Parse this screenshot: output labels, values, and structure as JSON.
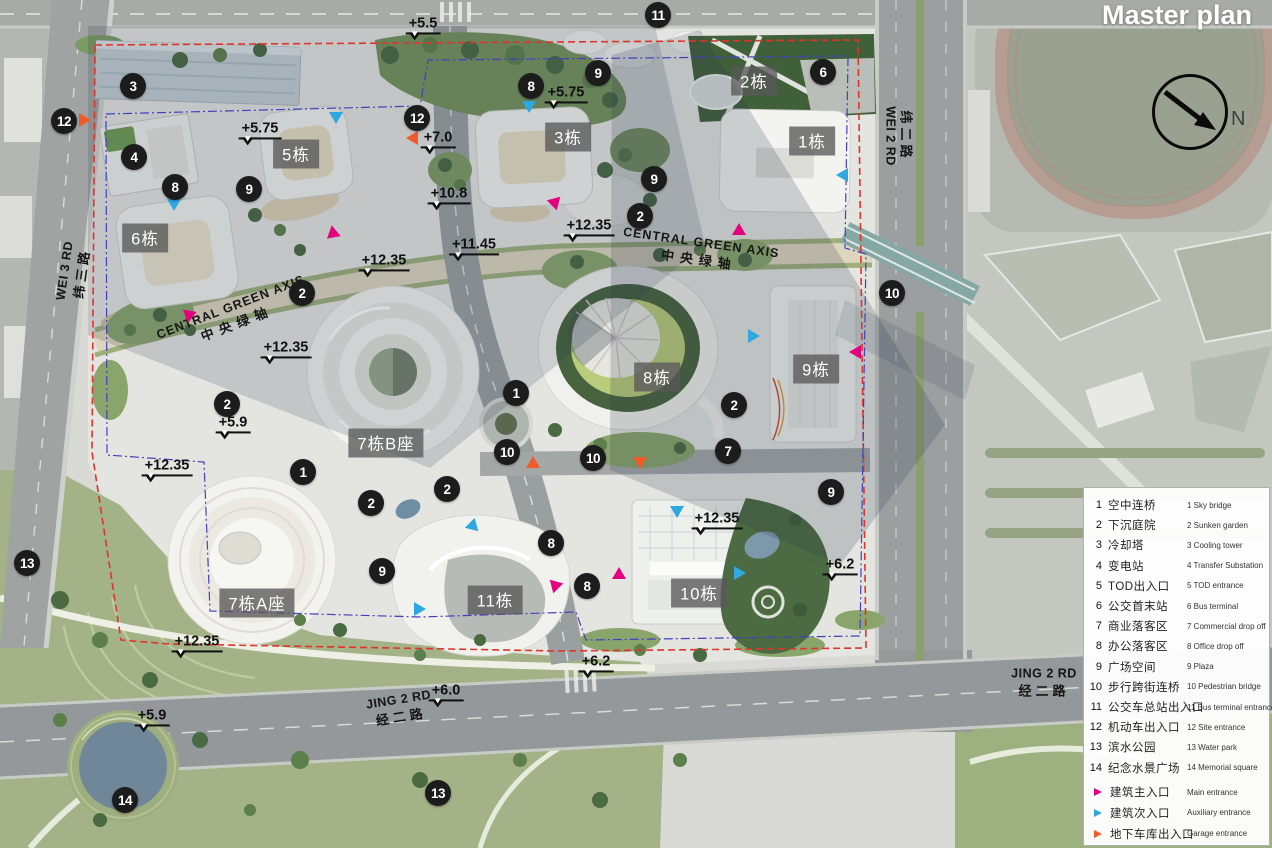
{
  "title": "Master plan",
  "compass": {
    "label": "N"
  },
  "colors": {
    "main_entrance": "#e5007d",
    "auxiliary_entrance": "#2da8e0",
    "garage_entrance": "#f15a29",
    "boundary_red": "#df342b",
    "boundary_blue": "#4340bf"
  },
  "roads": [
    {
      "en": "WEI 3 RD",
      "zh": "纬三路",
      "x": 74,
      "y": 272,
      "type": "vertical-left",
      "rotate": -82
    },
    {
      "en": "WEI 2 RD",
      "zh": "纬二路",
      "x": 900,
      "y": 136,
      "type": "vertical-right",
      "rotate": 90
    },
    {
      "en": "JING 2 RD",
      "zh": "经二路",
      "x": 400,
      "y": 709,
      "type": "horizontal",
      "rotate": -9
    },
    {
      "en": "JING 2 RD",
      "zh": "经二路",
      "x": 1044,
      "y": 683,
      "type": "horizontal",
      "rotate": 0
    }
  ],
  "axes": [
    {
      "en": "CENTRAL GREEN AXIS",
      "zh": "中央绿轴",
      "x": 234,
      "y": 316,
      "rotate": -21
    },
    {
      "en": "CENTRAL GREEN AXIS",
      "zh": "中央绿轴",
      "x": 700,
      "y": 252,
      "rotate": 8
    }
  ],
  "buildings": [
    {
      "label": "2栋",
      "x": 754,
      "y": 81
    },
    {
      "label": "5栋",
      "x": 296,
      "y": 154
    },
    {
      "label": "3栋",
      "x": 568,
      "y": 137
    },
    {
      "label": "1栋",
      "x": 812,
      "y": 141
    },
    {
      "label": "6栋",
      "x": 145,
      "y": 238
    },
    {
      "label": "8栋",
      "x": 657,
      "y": 377
    },
    {
      "label": "9栋",
      "x": 816,
      "y": 369
    },
    {
      "label": "7栋B座",
      "x": 386,
      "y": 443
    },
    {
      "label": "7栋A座",
      "x": 257,
      "y": 603
    },
    {
      "label": "11栋",
      "x": 495,
      "y": 600
    },
    {
      "label": "10栋",
      "x": 699,
      "y": 593
    }
  ],
  "markers": [
    {
      "n": "11",
      "x": 658,
      "y": 15
    },
    {
      "n": "3",
      "x": 133,
      "y": 86
    },
    {
      "n": "12",
      "x": 64,
      "y": 121
    },
    {
      "n": "8",
      "x": 531,
      "y": 86
    },
    {
      "n": "9",
      "x": 598,
      "y": 73
    },
    {
      "n": "6",
      "x": 823,
      "y": 72
    },
    {
      "n": "12",
      "x": 417,
      "y": 118
    },
    {
      "n": "4",
      "x": 134,
      "y": 157
    },
    {
      "n": "8",
      "x": 175,
      "y": 187
    },
    {
      "n": "9",
      "x": 249,
      "y": 189
    },
    {
      "n": "9",
      "x": 654,
      "y": 179
    },
    {
      "n": "2",
      "x": 640,
      "y": 216
    },
    {
      "n": "2",
      "x": 302,
      "y": 293
    },
    {
      "n": "10",
      "x": 892,
      "y": 293
    },
    {
      "n": "2",
      "x": 227,
      "y": 404
    },
    {
      "n": "1",
      "x": 516,
      "y": 393
    },
    {
      "n": "2",
      "x": 734,
      "y": 405
    },
    {
      "n": "7",
      "x": 728,
      "y": 451
    },
    {
      "n": "10",
      "x": 507,
      "y": 452
    },
    {
      "n": "10",
      "x": 593,
      "y": 458
    },
    {
      "n": "1",
      "x": 303,
      "y": 472
    },
    {
      "n": "2",
      "x": 371,
      "y": 503
    },
    {
      "n": "2",
      "x": 447,
      "y": 489
    },
    {
      "n": "9",
      "x": 831,
      "y": 492
    },
    {
      "n": "8",
      "x": 551,
      "y": 543
    },
    {
      "n": "8",
      "x": 587,
      "y": 586
    },
    {
      "n": "9",
      "x": 382,
      "y": 571
    },
    {
      "n": "13",
      "x": 27,
      "y": 563
    },
    {
      "n": "14",
      "x": 125,
      "y": 800
    },
    {
      "n": "13",
      "x": 438,
      "y": 793
    }
  ],
  "elevations": [
    {
      "t": "+5.5",
      "x": 423,
      "y": 27
    },
    {
      "t": "+5.75",
      "x": 260,
      "y": 132
    },
    {
      "t": "+5.75",
      "x": 566,
      "y": 96
    },
    {
      "t": "+7.0",
      "x": 438,
      "y": 141
    },
    {
      "t": "+10.8",
      "x": 449,
      "y": 197
    },
    {
      "t": "+11.45",
      "x": 474,
      "y": 248
    },
    {
      "t": "+12.35",
      "x": 589,
      "y": 229
    },
    {
      "t": "+12.35",
      "x": 384,
      "y": 264
    },
    {
      "t": "+12.35",
      "x": 286,
      "y": 351
    },
    {
      "t": "+5.9",
      "x": 233,
      "y": 426
    },
    {
      "t": "+12.35",
      "x": 167,
      "y": 469
    },
    {
      "t": "+12.35",
      "x": 197,
      "y": 645
    },
    {
      "t": "+5.9",
      "x": 152,
      "y": 719
    },
    {
      "t": "+12.35",
      "x": 717,
      "y": 522
    },
    {
      "t": "+6.2",
      "x": 840,
      "y": 568
    },
    {
      "t": "+6.2",
      "x": 596,
      "y": 665
    },
    {
      "t": "+6.0",
      "x": 446,
      "y": 694
    }
  ],
  "entrance_marks": [
    {
      "type": "main",
      "x": 191,
      "y": 315,
      "dir": 70
    },
    {
      "type": "main",
      "x": 335,
      "y": 235,
      "dir": 110
    },
    {
      "type": "main",
      "x": 556,
      "y": 202,
      "dir": 45
    },
    {
      "type": "main",
      "x": 739,
      "y": 230,
      "dir": 0
    },
    {
      "type": "main",
      "x": 855,
      "y": 353,
      "dir": 270
    },
    {
      "type": "main",
      "x": 554,
      "y": 585,
      "dir": 315
    },
    {
      "type": "main",
      "x": 619,
      "y": 574,
      "dir": 0
    },
    {
      "type": "auxiliary",
      "x": 336,
      "y": 119,
      "dir": 180
    },
    {
      "type": "auxiliary",
      "x": 174,
      "y": 206,
      "dir": 180
    },
    {
      "type": "auxiliary",
      "x": 529,
      "y": 108,
      "dir": 180
    },
    {
      "type": "auxiliary",
      "x": 842,
      "y": 176,
      "dir": 270
    },
    {
      "type": "auxiliary",
      "x": 754,
      "y": 337,
      "dir": 90
    },
    {
      "type": "auxiliary",
      "x": 474,
      "y": 528,
      "dir": 135
    },
    {
      "type": "auxiliary",
      "x": 677,
      "y": 513,
      "dir": 180
    },
    {
      "type": "auxiliary",
      "x": 740,
      "y": 574,
      "dir": 90
    },
    {
      "type": "auxiliary",
      "x": 420,
      "y": 610,
      "dir": 90
    },
    {
      "type": "garage",
      "x": 85,
      "y": 121,
      "dir": 90
    },
    {
      "type": "garage",
      "x": 412,
      "y": 139,
      "dir": 270
    },
    {
      "type": "garage",
      "x": 533,
      "y": 463,
      "dir": 0
    },
    {
      "type": "garage",
      "x": 640,
      "y": 464,
      "dir": 180
    }
  ],
  "legend": {
    "items": [
      {
        "num": "1",
        "zh": "空中连桥",
        "en": "1 Sky bridge"
      },
      {
        "num": "2",
        "zh": "下沉庭院",
        "en": "2 Sunken garden"
      },
      {
        "num": "3",
        "zh": "冷却塔",
        "en": "3 Cooling tower"
      },
      {
        "num": "4",
        "zh": "变电站",
        "en": "4 Transfer Substation"
      },
      {
        "num": "5",
        "zh": "TOD出入口",
        "en": "5 TOD entrance"
      },
      {
        "num": "6",
        "zh": "公交首末站",
        "en": "6 Bus terminal"
      },
      {
        "num": "7",
        "zh": "商业落客区",
        "en": "7 Commercial drop off"
      },
      {
        "num": "8",
        "zh": "办公落客区",
        "en": "8 Office drop off"
      },
      {
        "num": "9",
        "zh": "广场空间",
        "en": "9 Plaza"
      },
      {
        "num": "10",
        "zh": "步行跨街连桥",
        "en": "10 Pedestrian bridge"
      },
      {
        "num": "11",
        "zh": "公交车总站出入口",
        "en": "11 Bus terminal entrance"
      },
      {
        "num": "12",
        "zh": "机动车出入口",
        "en": "12 Site entrance"
      },
      {
        "num": "13",
        "zh": "滨水公园",
        "en": "13 Water park"
      },
      {
        "num": "14",
        "zh": "纪念水景广场",
        "en": "14 Memorial square"
      }
    ],
    "entrances": [
      {
        "type": "main",
        "zh": "建筑主入口",
        "en": "Main entrance"
      },
      {
        "type": "auxiliary",
        "zh": "建筑次入口",
        "en": "Auxiliary entrance"
      },
      {
        "type": "garage",
        "zh": "地下车库出入口",
        "en": "Garage entrance"
      }
    ]
  }
}
